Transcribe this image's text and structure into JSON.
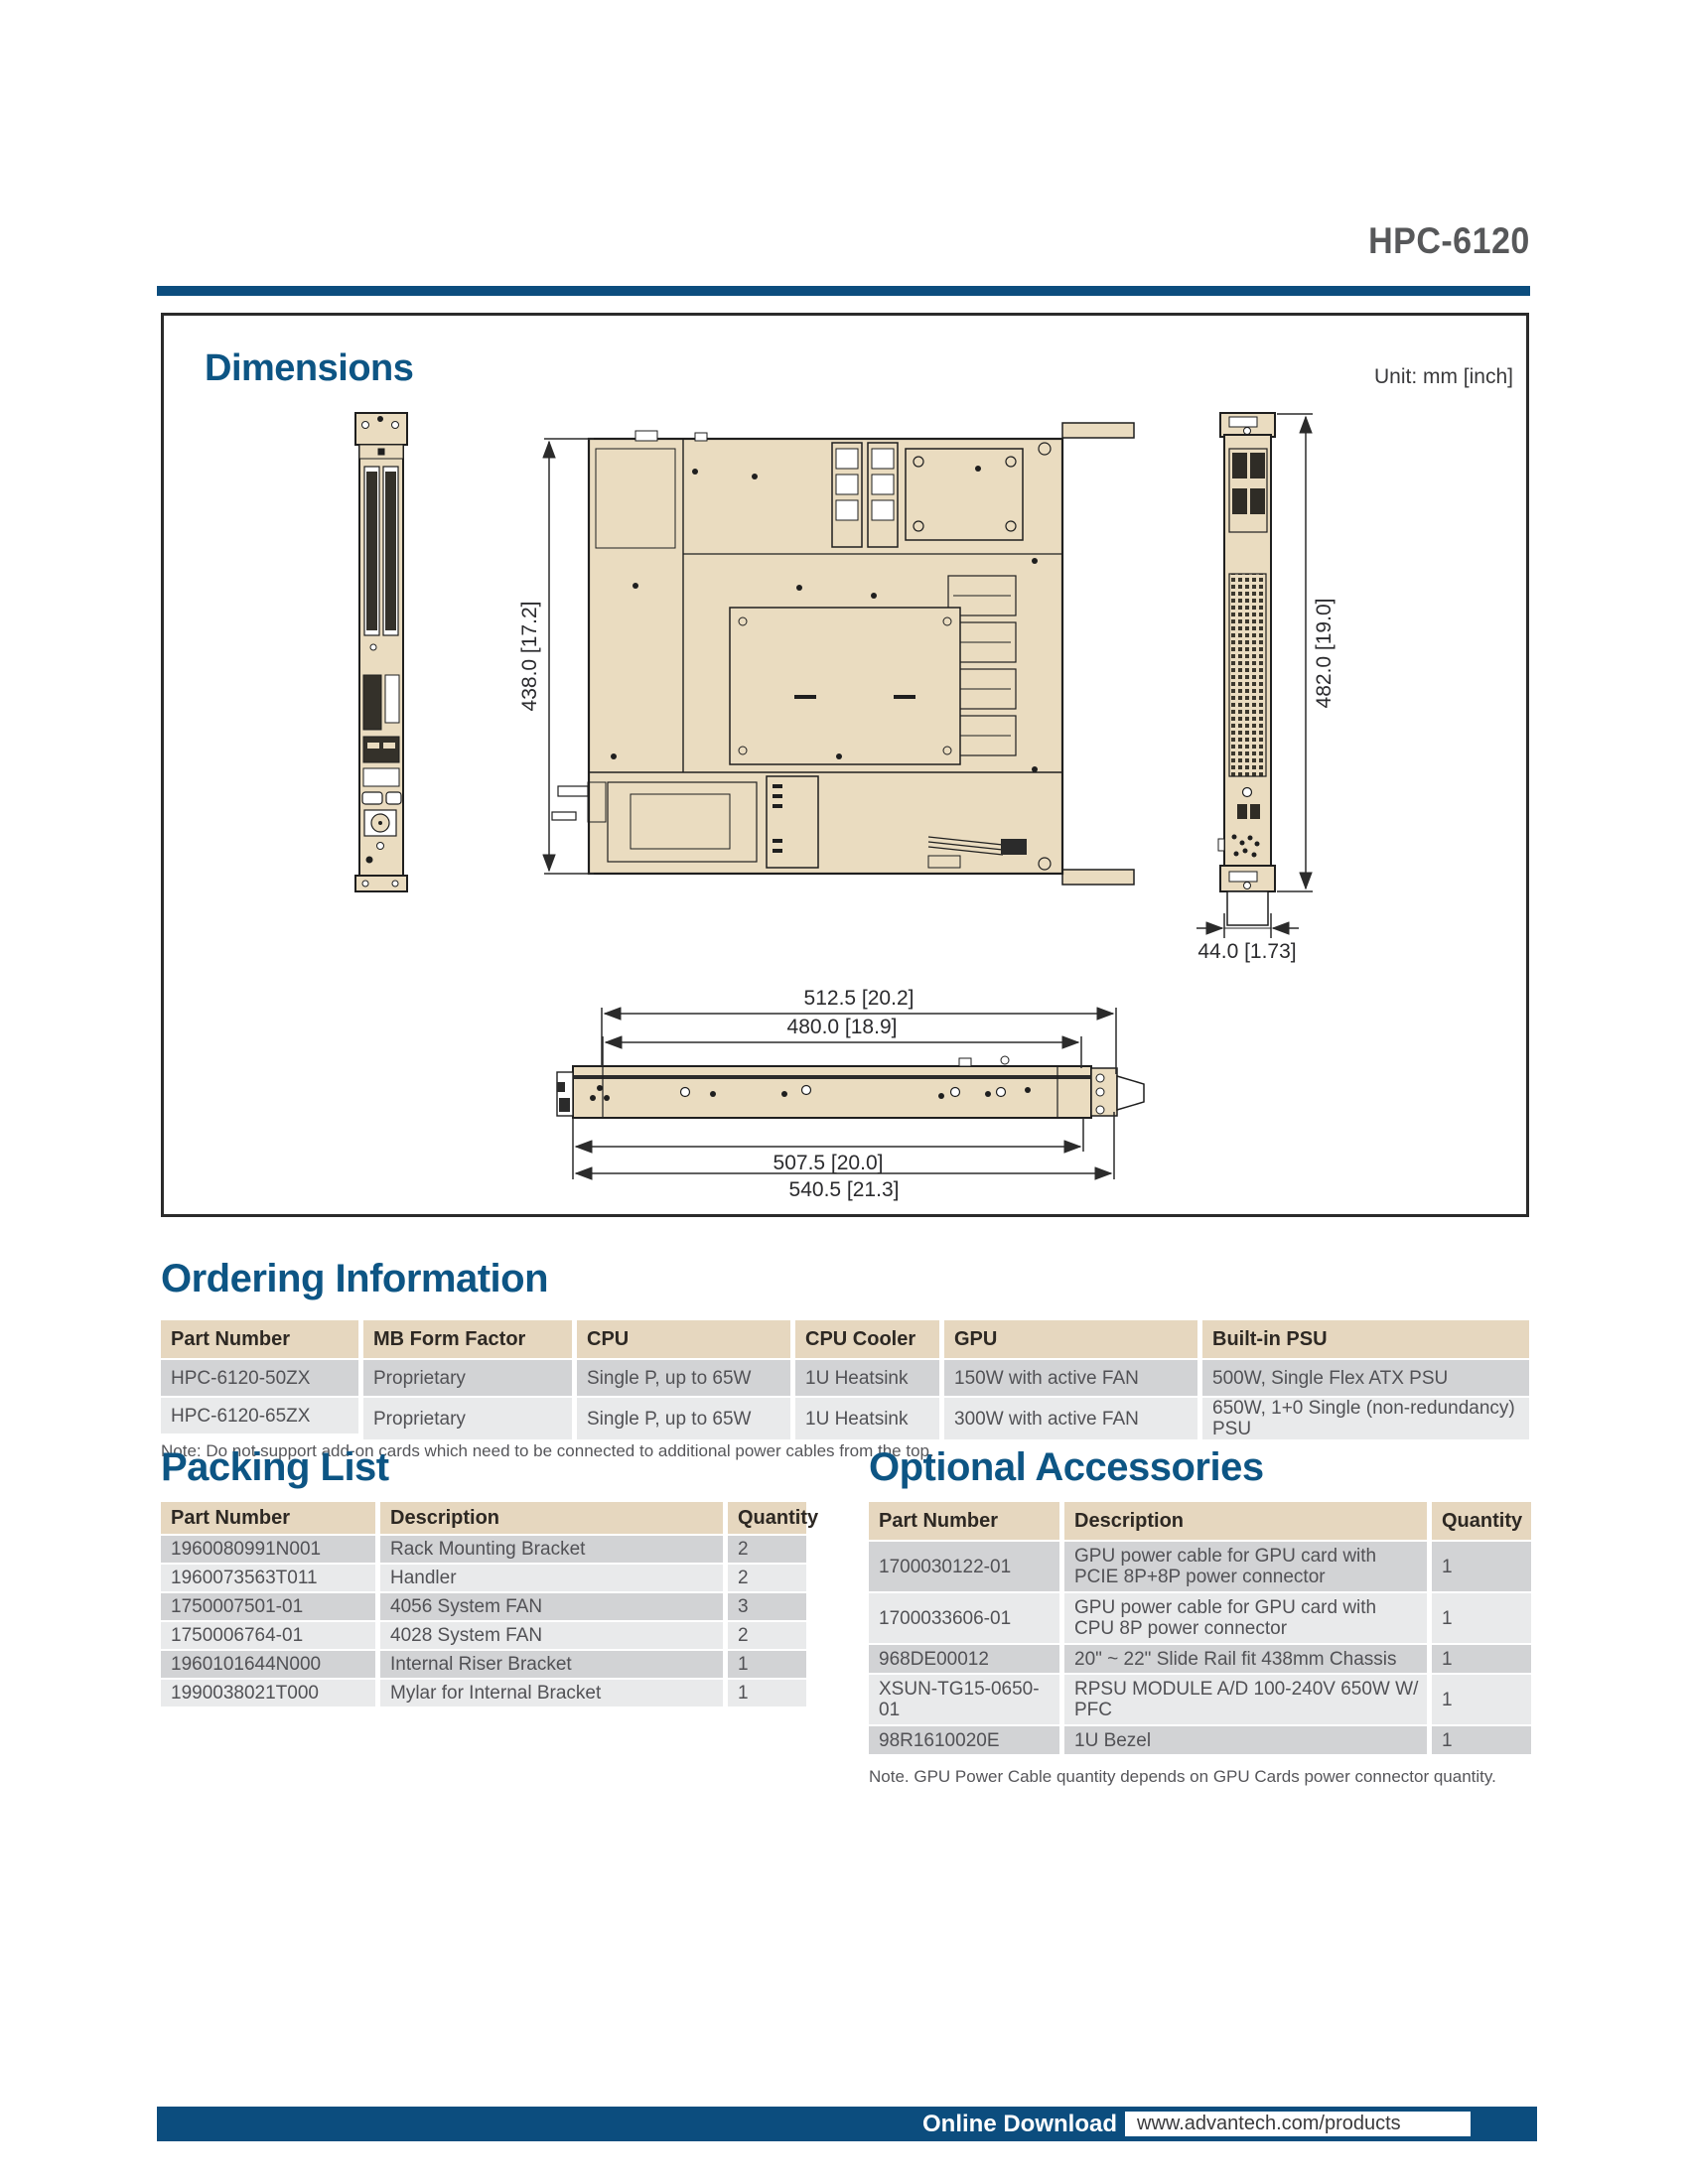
{
  "page": {
    "product": "HPC-6120"
  },
  "dimensions": {
    "title": "Dimensions",
    "unit": "Unit: mm [inch]",
    "labels": {
      "depth": "438.0 [17.2]",
      "front_height": "482.0 [19.0]",
      "unit_height": "44.0 [1.73]",
      "top_width": "512.5 [20.2]",
      "inner_width": "480.0 [18.9]",
      "body_width": "507.5 [20.0]",
      "total_width": "540.5 [21.3]"
    }
  },
  "ordering": {
    "title": "Ordering Information",
    "headers": [
      "Part Number",
      "MB Form Factor",
      "CPU",
      "CPU Cooler",
      "GPU",
      "Built-in PSU"
    ],
    "rows": [
      [
        "HPC-6120-50ZX",
        "Proprietary",
        "Single P, up to 65W",
        "1U Heatsink",
        "150W with active FAN",
        "500W, Single Flex ATX PSU"
      ],
      [
        "HPC-6120-65ZX",
        "Proprietary",
        "Single P, up to 65W",
        "1U Heatsink",
        "300W with active FAN",
        "650W, 1+0 Single (non-redundancy) PSU"
      ]
    ],
    "note": "Note: Do not support add-on cards which need to be connected to additional power cables from the top."
  },
  "packing": {
    "title": "Packing List",
    "headers": [
      "Part Number",
      "Description",
      "Quantity"
    ],
    "rows": [
      [
        "1960080991N001",
        "Rack Mounting Bracket",
        "2"
      ],
      [
        "1960073563T011",
        "Handler",
        "2"
      ],
      [
        "1750007501-01",
        "4056 System FAN",
        "3"
      ],
      [
        "1750006764-01",
        "4028 System FAN",
        "2"
      ],
      [
        "1960101644N000",
        "Internal Riser Bracket",
        "1"
      ],
      [
        "1990038021T000",
        "Mylar for Internal Bracket",
        "1"
      ]
    ]
  },
  "optional": {
    "title": "Optional Accessories",
    "headers": [
      "Part Number",
      "Description",
      "Quantity"
    ],
    "rows": [
      [
        "1700030122-01",
        "GPU power cable for GPU card with PCIE 8P+8P power connector",
        "1"
      ],
      [
        "1700033606-01",
        "GPU power cable for GPU card with CPU 8P power connector",
        "1"
      ],
      [
        "968DE00012",
        "20\" ~ 22\" Slide Rail fit 438mm Chassis",
        "1"
      ],
      [
        "XSUN-TG15-0650-01",
        "RPSU MODULE A/D 100-240V 650W W/ PFC",
        "1"
      ],
      [
        "98R1610020E",
        "1U Bezel",
        "1"
      ]
    ],
    "note": "Note. GPU Power Cable quantity depends on GPU Cards power connector quantity."
  },
  "footer": {
    "label": "Online Download",
    "url": "www.advantech.com/products"
  },
  "colors": {
    "brand_blue": "#0c4d7e",
    "heading_blue": "#0d5584",
    "table_header_tan": "#e6d7bf",
    "row_dark": "#d2d3d5",
    "row_light": "#e9eaeb",
    "drawing_fill": "#eadcc0"
  }
}
